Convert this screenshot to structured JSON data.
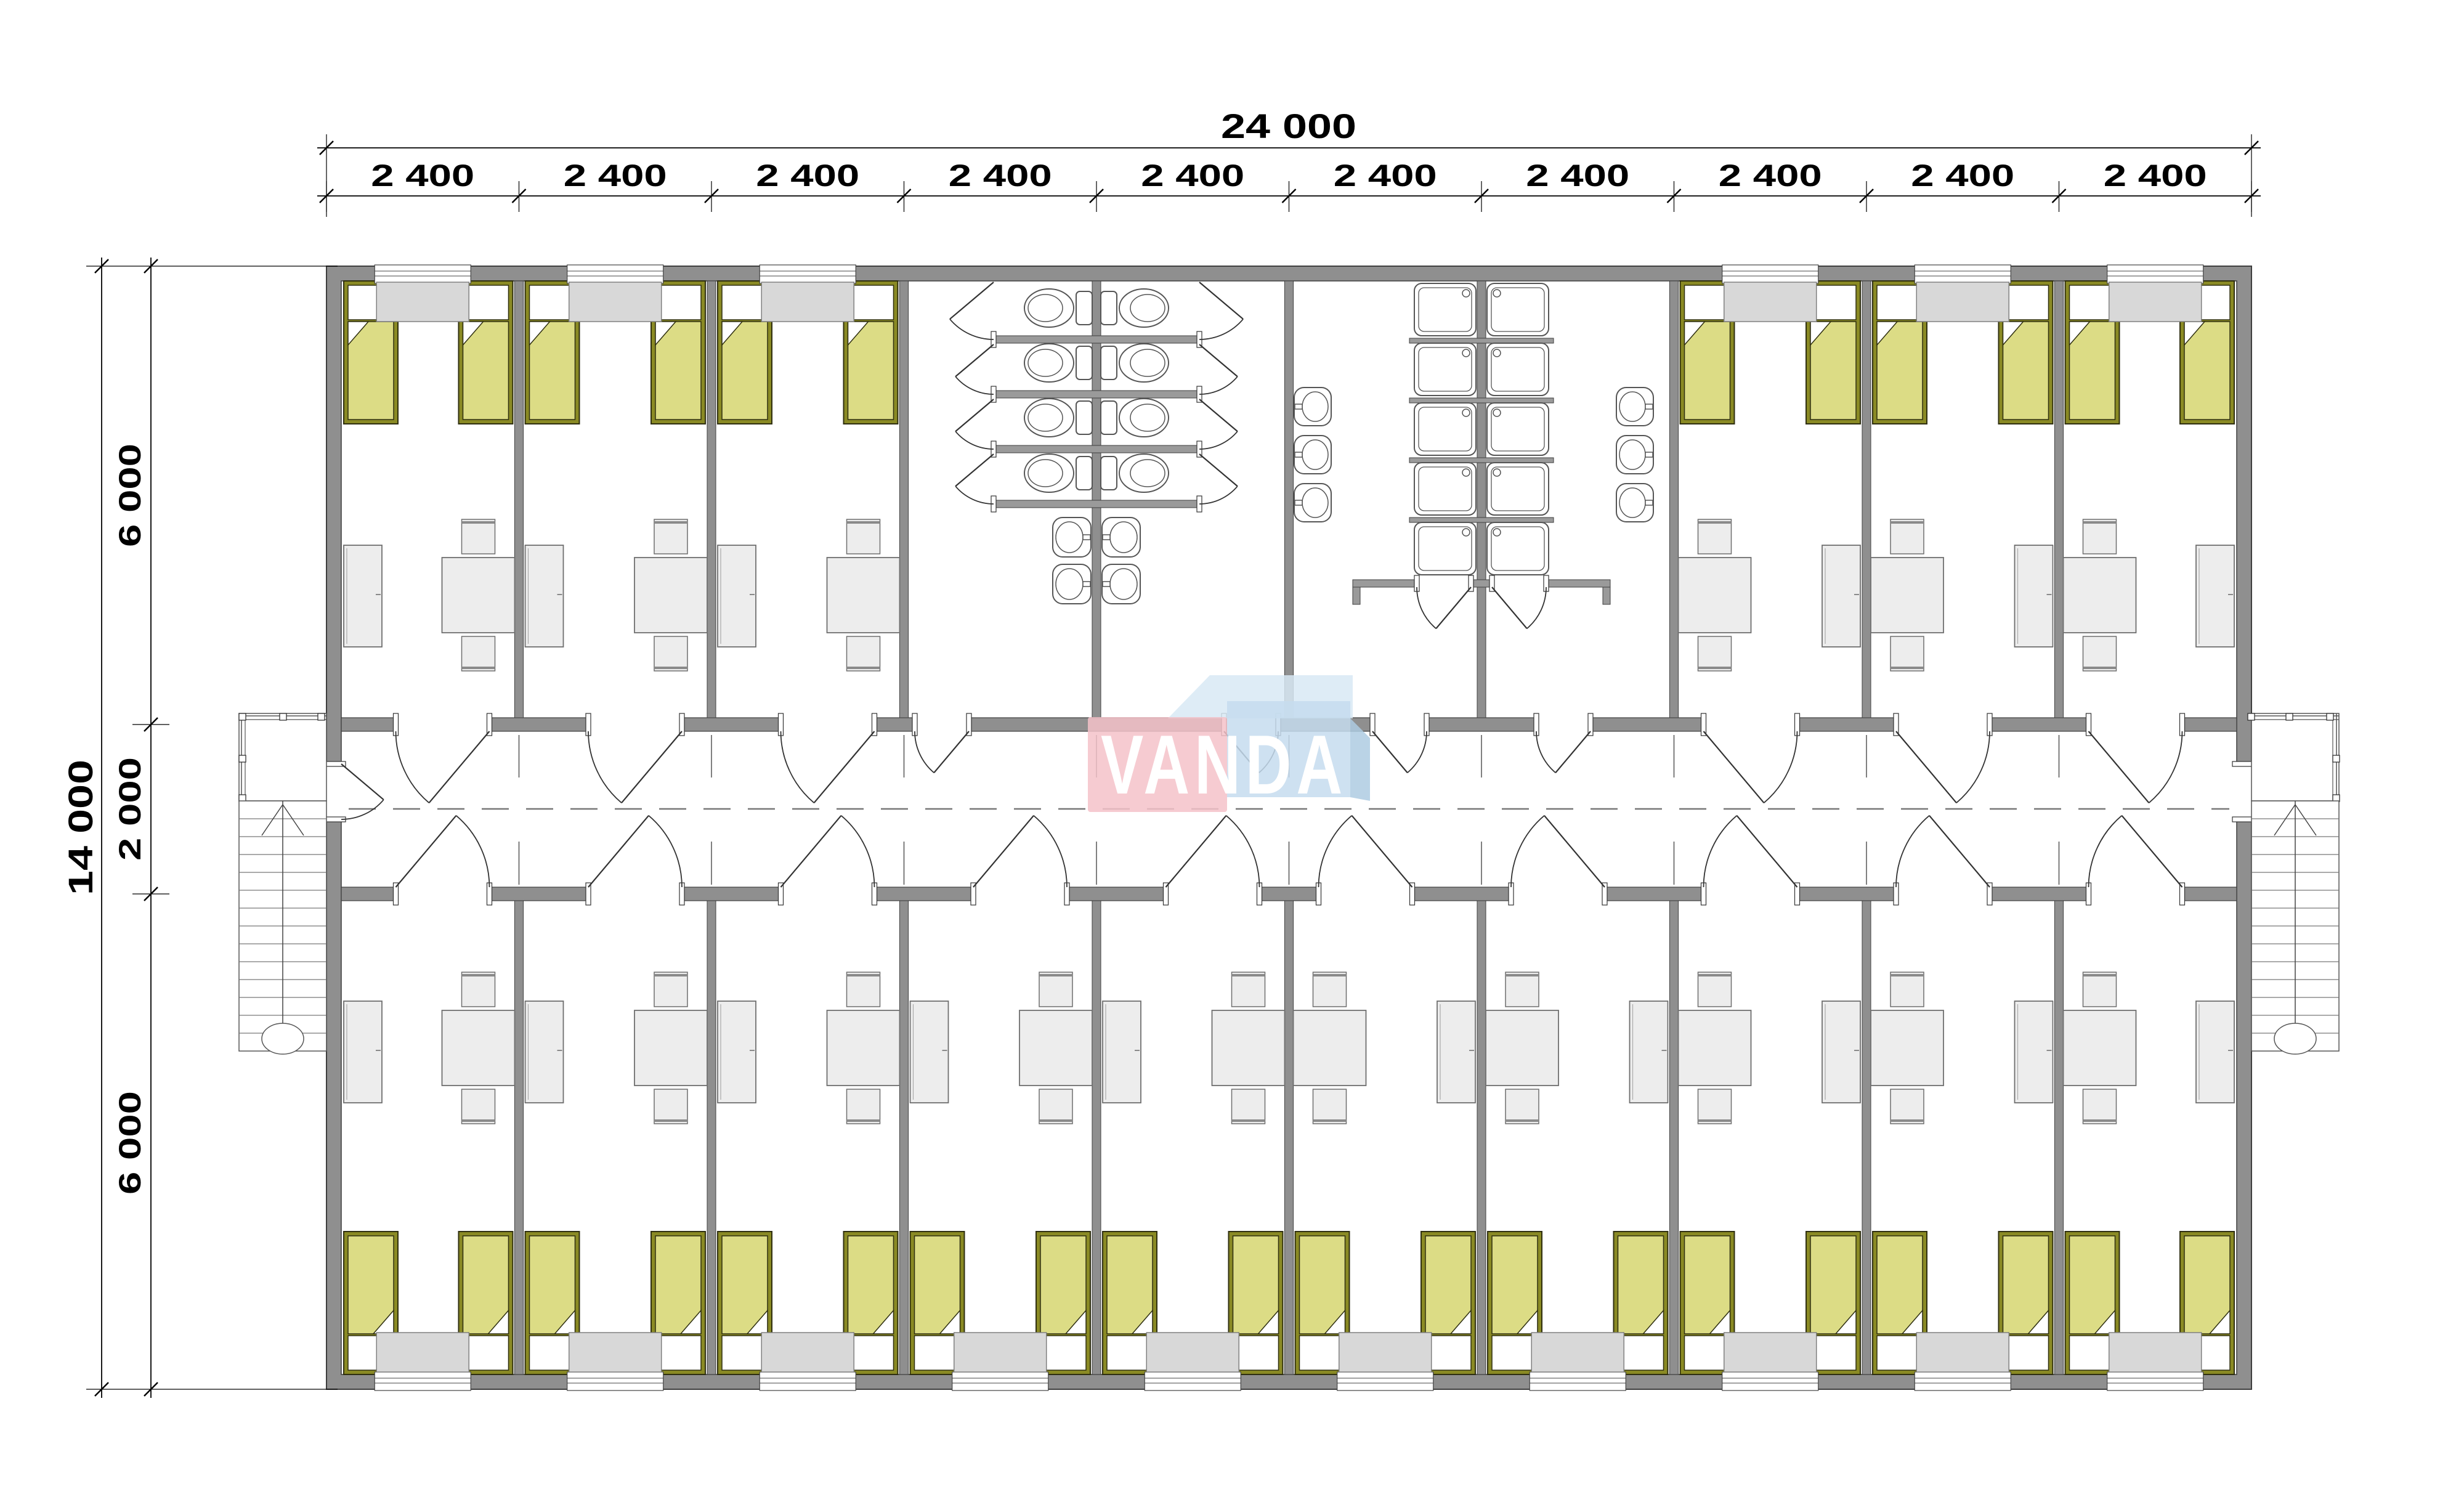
{
  "drawing": {
    "logo": {
      "text": "VANDA"
    },
    "dimensions": {
      "overall_width": "24 000",
      "module_width": "2 400",
      "module_count": 10,
      "overall_depth": "14 000",
      "upper_rooms_depth": "6 000",
      "corridor_depth": "2 000",
      "lower_rooms_depth": "6 000"
    },
    "counts": {
      "upper_dorm_rooms": 6,
      "lower_dorm_rooms": 10,
      "beds": 32,
      "toilets": 8,
      "wc_sinks": 4,
      "shower_trays": 10,
      "shower_room_sinks": 6,
      "dining_tables": 16,
      "wardrobes": 16,
      "staircases": 2
    }
  },
  "colors": {
    "wall": "#8f8f8f",
    "wall_outline": "#3f3f3f",
    "stall_wall": "#9a9a9a",
    "bed_frame": "#8a8a24",
    "bed_frame_line": "#2f2f10",
    "bed_fill": "#dcdc85",
    "linen": "#ffffff",
    "furniture": "#ededed",
    "furniture_outline": "#6f6f6f",
    "cabinet": "#d8d8d8",
    "fixture_outline": "#555555",
    "door_line": "#333333",
    "centerline": "#777777",
    "dim": "#000000",
    "logo_pink": "#f5c2c9",
    "logo_blue": "#c5dcee",
    "logo_blue_light": "#d8e9f5",
    "logo_blue_dark": "#aecbe2",
    "logo_text": "#ffffff"
  }
}
